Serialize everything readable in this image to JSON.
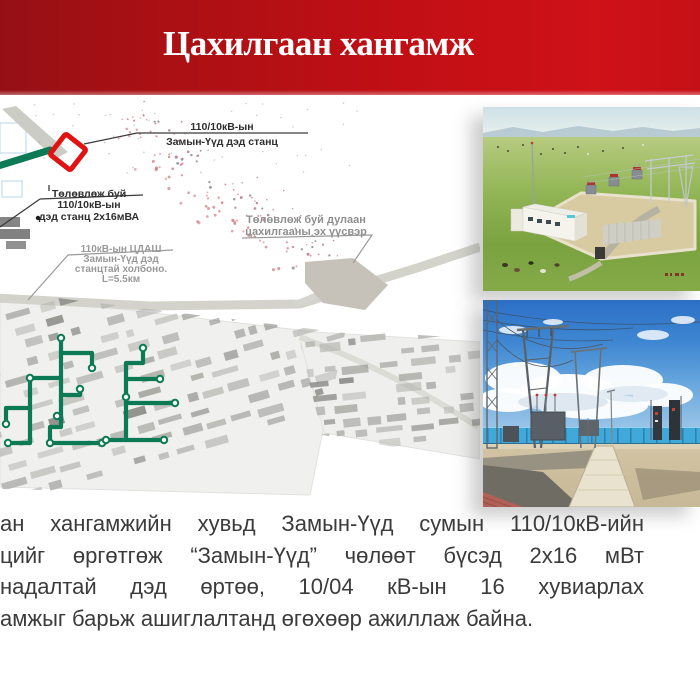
{
  "slide": {
    "title": "Цахилгаан хангамж"
  },
  "banner": {
    "color_left": "#951015",
    "color_right": "#cf1118"
  },
  "map": {
    "labels": {
      "substation": {
        "line1": "110/10кВ-ын",
        "line2": "Замын-Үүд дэд станц"
      },
      "planned_substation": {
        "line1": "Төлөвлөж буй",
        "line2": "110/10кВ-ын",
        "line3": "дэд станц 2х16мВА"
      },
      "heat_source": {
        "line1": "Төлөвлөж буй дулаан",
        "line2": "цахилгааны эх үүсвэр"
      },
      "transmission_line": {
        "line1": "110кВ-ын ЦДАШ",
        "line2": "Замын-Үүд дэд",
        "line3": "станцтай холбоно.",
        "line4": "L=5.5км"
      }
    },
    "colors": {
      "network_green": "#0c7a55",
      "marker_red": "#e01212"
    }
  },
  "paragraph": {
    "lines": [
      "ан хангамжийн хувьд Замын-Үүд сумын 110/10кВ-ийн",
      "цийг өргөтгөж “Замын-Үүд” чөлөөт бүсэд 2х16 мВт",
      "надалтай дэд өртөө, 10/04 кВ-ын 16 хувиарлах",
      "амжыг барьж ашиглалтанд өгөхөөр ажиллаж байна."
    ]
  }
}
